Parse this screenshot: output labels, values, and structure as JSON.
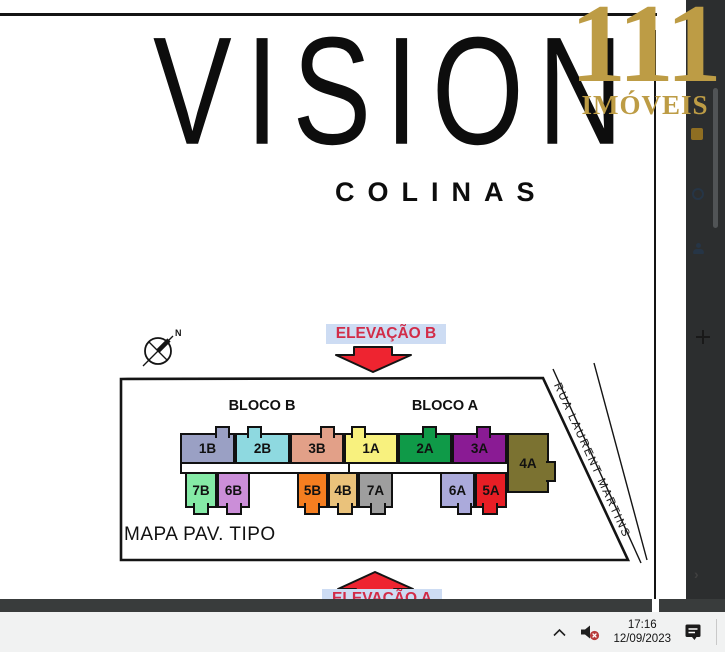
{
  "brand": {
    "number": "111",
    "name": "IMÓVEIS",
    "gold": "#bd9c45"
  },
  "poster": {
    "title": "VISION",
    "subtitle": "COLINAS"
  },
  "sitemap": {
    "compass_label": "N",
    "elevation_top": "ELEVAÇÃO B",
    "elevation_bottom": "ELEVAÇÃO A",
    "street_label": "RUA LAURENT MARTINS",
    "caption": "MAPA PAV. TIPO",
    "block_b": "BLOCO B",
    "block_a": "BLOCO A",
    "label_bg": "#cddcf3",
    "label_fg": "#d22c48",
    "arrow_fill": "#ee2430",
    "units_top": [
      {
        "label": "1B",
        "color": "#9aa0c4",
        "x": 180,
        "w": 55,
        "tab_dx": 33,
        "tab_w": 15
      },
      {
        "label": "2B",
        "color": "#8ed9e0",
        "x": 235,
        "w": 55,
        "tab_dx": 10,
        "tab_w": 15
      },
      {
        "label": "3B",
        "color": "#e2a088",
        "x": 290,
        "w": 54,
        "tab_dx": 28,
        "tab_w": 15
      },
      {
        "label": "1A",
        "color": "#f8f17e",
        "x": 344,
        "w": 54,
        "tab_dx": 5,
        "tab_w": 15
      },
      {
        "label": "2A",
        "color": "#0f9a48",
        "x": 398,
        "w": 54,
        "tab_dx": 22,
        "tab_w": 15
      },
      {
        "label": "3A",
        "color": "#8a1b94",
        "x": 452,
        "w": 55,
        "tab_dx": 22,
        "tab_w": 15
      }
    ],
    "units_bottom": [
      {
        "label": "7B",
        "color": "#85eaa6",
        "x": 185,
        "w": 32,
        "tab_dx": 6,
        "tab_w": 16
      },
      {
        "label": "6B",
        "color": "#cb8ed8",
        "x": 217,
        "w": 33,
        "tab_dx": 7,
        "tab_w": 16
      },
      {
        "label": "5B",
        "color": "#f57e20",
        "x": 297,
        "w": 31,
        "tab_dx": 5,
        "tab_w": 16
      },
      {
        "label": "4B",
        "color": "#eac27b",
        "x": 328,
        "w": 30,
        "tab_dx": 7,
        "tab_w": 16
      },
      {
        "label": "7A",
        "color": "#9e9e9e",
        "x": 358,
        "w": 35,
        "tab_dx": 10,
        "tab_w": 16
      },
      {
        "label": "6A",
        "color": "#abaadb",
        "x": 440,
        "w": 35,
        "tab_dx": 15,
        "tab_w": 15
      },
      {
        "label": "5A",
        "color": "#e71e25",
        "x": 475,
        "w": 32,
        "tab_dx": 5,
        "tab_w": 16
      }
    ],
    "unit_corner": {
      "label": "4A",
      "color": "#7b7231"
    }
  },
  "sidebar": {
    "icons": [
      "image-thumbnail",
      "history-icon",
      "people-icon",
      "add-icon",
      "chevron-right-icon"
    ]
  },
  "taskbar": {
    "time": "17:16",
    "date": "12/09/2023",
    "tray": [
      "chevron-up",
      "volume-muted",
      "notifications"
    ]
  }
}
